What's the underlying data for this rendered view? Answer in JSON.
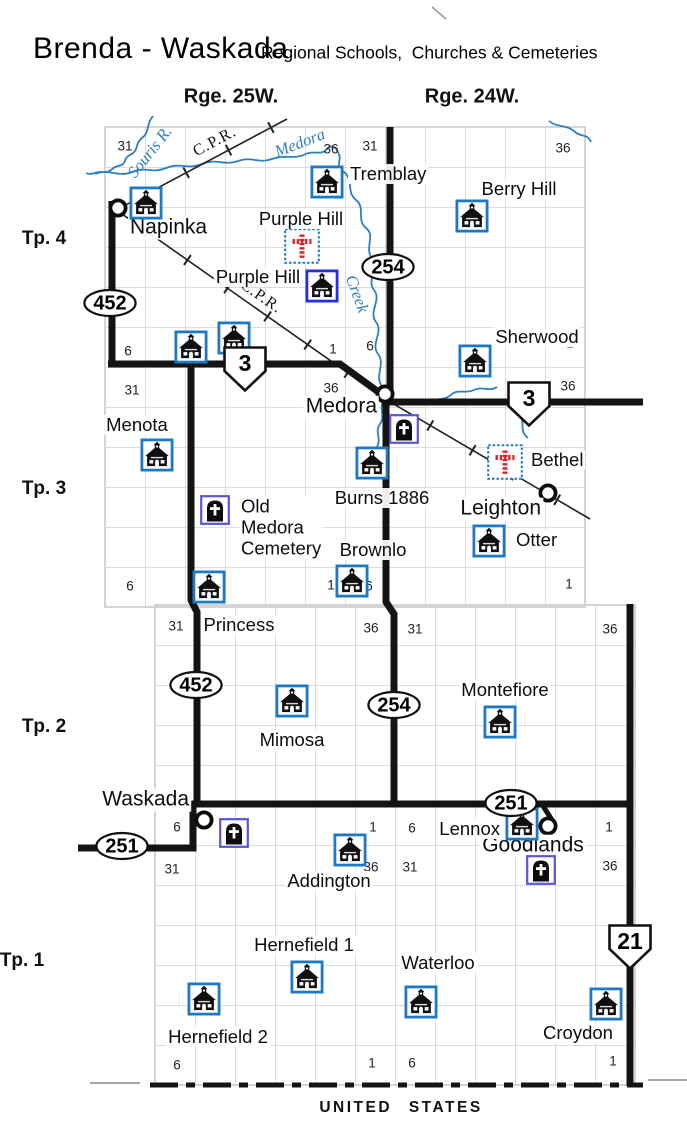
{
  "header": {
    "title": "Brenda - Waskada",
    "subtitle": "Regional Schools,  Churches & Cemeteries"
  },
  "colors": {
    "school": "#1d79c4",
    "school_alt": "#2330e0",
    "cem": "#5b54d6",
    "cross": "#d6252e",
    "water": "#2e7fc0",
    "road": "#141414",
    "grid": "#dcdcdc"
  },
  "map": {
    "border_label": "UNITED STATES",
    "range_labels": [
      {
        "label": "Rge. 25W.",
        "x": 231,
        "y": 97
      },
      {
        "label": "Rge. 24W.",
        "x": 472,
        "y": 97
      }
    ],
    "township_labels": [
      {
        "label": "Tp. 4",
        "x": 44,
        "y": 239
      },
      {
        "label": "Tp. 3",
        "x": 44,
        "y": 489
      },
      {
        "label": "Tp. 2",
        "x": 44,
        "y": 727
      },
      {
        "label": "Tp. 1",
        "x": 22,
        "y": 961
      }
    ],
    "railway_labels": [
      {
        "label": "C.P.R.",
        "x": 215,
        "y": 142,
        "rotate": -28
      },
      {
        "label": "C.P.R.",
        "x": 261,
        "y": 297,
        "rotate": 35
      }
    ],
    "water_labels": [
      {
        "label": "Souris R.",
        "x": 150,
        "y": 152,
        "rotate": -52
      },
      {
        "label": "Medora",
        "x": 300,
        "y": 143,
        "rotate": -21
      },
      {
        "label": "Creek",
        "x": 357,
        "y": 294,
        "rotate": 70
      }
    ],
    "section_numbers": [
      {
        "n": "31",
        "x": 125,
        "y": 146
      },
      {
        "n": "36",
        "x": 331,
        "y": 149
      },
      {
        "n": "31",
        "x": 370,
        "y": 146
      },
      {
        "n": "36",
        "x": 563,
        "y": 148
      },
      {
        "n": "6",
        "x": 128,
        "y": 351
      },
      {
        "n": "1",
        "x": 333,
        "y": 349
      },
      {
        "n": "6",
        "x": 370,
        "y": 346
      },
      {
        "n": "1",
        "x": 570,
        "y": 343
      },
      {
        "n": "31",
        "x": 132,
        "y": 390
      },
      {
        "n": "36",
        "x": 331,
        "y": 388
      },
      {
        "n": "36",
        "x": 568,
        "y": 386
      },
      {
        "n": "6",
        "x": 130,
        "y": 586
      },
      {
        "n": "1",
        "x": 331,
        "y": 585
      },
      {
        "n": "6",
        "x": 369,
        "y": 586
      },
      {
        "n": "1",
        "x": 569,
        "y": 584
      },
      {
        "n": "31",
        "x": 176,
        "y": 626
      },
      {
        "n": "36",
        "x": 371,
        "y": 628
      },
      {
        "n": "31",
        "x": 415,
        "y": 629
      },
      {
        "n": "36",
        "x": 610,
        "y": 629
      },
      {
        "n": "6",
        "x": 177,
        "y": 827
      },
      {
        "n": "1",
        "x": 373,
        "y": 827
      },
      {
        "n": "6",
        "x": 412,
        "y": 828
      },
      {
        "n": "1",
        "x": 609,
        "y": 827
      },
      {
        "n": "31",
        "x": 172,
        "y": 869
      },
      {
        "n": "36",
        "x": 371,
        "y": 867
      },
      {
        "n": "31",
        "x": 410,
        "y": 867
      },
      {
        "n": "36",
        "x": 610,
        "y": 866
      },
      {
        "n": "6",
        "x": 177,
        "y": 1065
      },
      {
        "n": "1",
        "x": 372,
        "y": 1063
      },
      {
        "n": "6",
        "x": 412,
        "y": 1063
      },
      {
        "n": "1",
        "x": 613,
        "y": 1061
      }
    ],
    "highways": [
      {
        "shape": "oval",
        "num": "452",
        "x": 110,
        "y": 303
      },
      {
        "shape": "oval",
        "num": "254",
        "x": 388,
        "y": 267
      },
      {
        "shape": "shield",
        "num": "3",
        "x": 245,
        "y": 369
      },
      {
        "shape": "shield",
        "num": "3",
        "x": 529,
        "y": 404
      },
      {
        "shape": "oval",
        "num": "452",
        "x": 196,
        "y": 685
      },
      {
        "shape": "oval",
        "num": "254",
        "x": 394,
        "y": 705
      },
      {
        "shape": "oval",
        "num": "251",
        "x": 122,
        "y": 846
      },
      {
        "shape": "oval",
        "num": "251",
        "x": 511,
        "y": 803
      },
      {
        "shape": "shield",
        "num": "21",
        "x": 630,
        "y": 947
      }
    ],
    "features": [
      {
        "kind": "town",
        "name": "napinka",
        "icon": {
          "x": 118,
          "y": 208
        },
        "label": "Napinka",
        "label_pos": {
          "x": 128,
          "y": 228,
          "anchor": "start"
        }
      },
      {
        "kind": "town",
        "name": "medora",
        "icon": {
          "x": 385,
          "y": 394
        },
        "label": "Medora",
        "label_pos": {
          "x": 379,
          "y": 407,
          "anchor": "end"
        }
      },
      {
        "kind": "town",
        "name": "leighton",
        "icon": {
          "x": 548,
          "y": 493
        },
        "label": "Leighton",
        "label_pos": {
          "x": 543,
          "y": 509,
          "anchor": "end"
        }
      },
      {
        "kind": "town",
        "name": "waskada",
        "icon": {
          "x": 204,
          "y": 820
        },
        "label": "Waskada",
        "label_pos": {
          "x": 191,
          "y": 800,
          "anchor": "end"
        }
      },
      {
        "kind": "town",
        "name": "goodlands",
        "icon": {
          "x": 548,
          "y": 826
        },
        "label": "Goodlands",
        "label_pos": {
          "x": 533,
          "y": 846,
          "anchor": "middle"
        }
      },
      {
        "kind": "school",
        "name": "napinka-school",
        "icon": {
          "x": 146,
          "y": 203
        }
      },
      {
        "kind": "school",
        "name": "tremblay",
        "icon": {
          "x": 327,
          "y": 182
        },
        "label": "Tremblay",
        "label_pos": {
          "x": 348,
          "y": 174,
          "anchor": "start"
        }
      },
      {
        "kind": "school",
        "name": "berry-hill",
        "icon": {
          "x": 472,
          "y": 216
        },
        "label": "Berry Hill",
        "label_pos": {
          "x": 519,
          "y": 189,
          "anchor": "middle"
        }
      },
      {
        "kind": "red_cross",
        "name": "purple-hill-church",
        "icon": {
          "x": 302,
          "y": 246
        },
        "label": "Purple Hill",
        "label_pos": {
          "x": 301,
          "y": 219,
          "anchor": "middle"
        }
      },
      {
        "kind": "school",
        "name": "purple-hill-school",
        "variant": "royal",
        "icon": {
          "x": 322,
          "y": 286
        },
        "label": "Purple Hill",
        "label_pos": {
          "x": 258,
          "y": 277,
          "anchor": "middle"
        }
      },
      {
        "kind": "school",
        "name": "hwy3-school-west",
        "icon": {
          "x": 191,
          "y": 347
        }
      },
      {
        "kind": "school",
        "name": "hwy3-school-east",
        "icon": {
          "x": 234,
          "y": 338
        }
      },
      {
        "kind": "school",
        "name": "sherwood",
        "icon": {
          "x": 475,
          "y": 361
        },
        "label": "Sherwood",
        "label_pos": {
          "x": 537,
          "y": 337,
          "anchor": "middle"
        }
      },
      {
        "kind": "school",
        "name": "menota",
        "icon": {
          "x": 157,
          "y": 455
        },
        "label": "Menota",
        "label_pos": {
          "x": 137,
          "y": 425,
          "anchor": "middle"
        }
      },
      {
        "kind": "cemetery",
        "name": "medora-cemetery",
        "icon": {
          "x": 404,
          "y": 429
        }
      },
      {
        "kind": "school",
        "name": "burns",
        "icon": {
          "x": 372,
          "y": 463
        },
        "label": "Burns 1886",
        "label_pos": {
          "x": 382,
          "y": 498,
          "anchor": "middle"
        }
      },
      {
        "kind": "red_cross",
        "name": "bethel",
        "icon": {
          "x": 505,
          "y": 462
        },
        "label": "Bethel",
        "label_pos": {
          "x": 529,
          "y": 460,
          "anchor": "start"
        }
      },
      {
        "kind": "school",
        "name": "otter",
        "icon": {
          "x": 489,
          "y": 541
        },
        "label": "Otter",
        "label_pos": {
          "x": 514,
          "y": 540,
          "anchor": "start"
        }
      },
      {
        "kind": "cemetery",
        "name": "old-medora-cemetery",
        "icon": {
          "x": 215,
          "y": 510
        },
        "label_lines": [
          "Old",
          "Medora",
          "Cemetery"
        ],
        "label_pos": {
          "x": 239,
          "y": 527,
          "anchor": "start"
        }
      },
      {
        "kind": "school",
        "name": "princess",
        "icon": {
          "x": 209,
          "y": 587
        },
        "label": "Princess",
        "label_pos": {
          "x": 239,
          "y": 625,
          "anchor": "middle"
        }
      },
      {
        "kind": "school",
        "name": "brownlo",
        "icon": {
          "x": 352,
          "y": 581
        },
        "label": "Brownlo",
        "label_pos": {
          "x": 373,
          "y": 550,
          "anchor": "middle"
        }
      },
      {
        "kind": "school",
        "name": "mimosa",
        "icon": {
          "x": 292,
          "y": 701
        },
        "label": "Mimosa",
        "label_pos": {
          "x": 292,
          "y": 740,
          "anchor": "middle"
        }
      },
      {
        "kind": "school",
        "name": "montefiore",
        "icon": {
          "x": 500,
          "y": 722
        },
        "label": "Montefiore",
        "label_pos": {
          "x": 505,
          "y": 690,
          "anchor": "middle"
        }
      },
      {
        "kind": "cemetery",
        "name": "waskada-cemetery",
        "icon": {
          "x": 234,
          "y": 833
        }
      },
      {
        "kind": "school",
        "name": "lennox",
        "icon": {
          "x": 522,
          "y": 824
        },
        "label": "Lennox",
        "label_pos": {
          "x": 502,
          "y": 829,
          "anchor": "end"
        }
      },
      {
        "kind": "cemetery",
        "name": "goodlands-cemetery",
        "icon": {
          "x": 541,
          "y": 870
        }
      },
      {
        "kind": "school",
        "name": "addington",
        "icon": {
          "x": 350,
          "y": 850
        },
        "label": "Addington",
        "label_pos": {
          "x": 329,
          "y": 881,
          "anchor": "middle"
        }
      },
      {
        "kind": "school",
        "name": "hernefield-1",
        "icon": {
          "x": 307,
          "y": 977
        },
        "label": "Hernefield 1",
        "label_pos": {
          "x": 304,
          "y": 945,
          "anchor": "middle"
        }
      },
      {
        "kind": "school",
        "name": "hernefield-2",
        "icon": {
          "x": 204,
          "y": 999
        },
        "label": "Hernefield 2",
        "label_pos": {
          "x": 218,
          "y": 1037,
          "anchor": "middle"
        }
      },
      {
        "kind": "school",
        "name": "waterloo",
        "icon": {
          "x": 421,
          "y": 1002
        },
        "label": "Waterloo",
        "label_pos": {
          "x": 438,
          "y": 963,
          "anchor": "middle"
        }
      },
      {
        "kind": "school",
        "name": "croydon",
        "icon": {
          "x": 606,
          "y": 1004
        },
        "label": "Croydon",
        "label_pos": {
          "x": 578,
          "y": 1033,
          "anchor": "middle"
        }
      }
    ]
  }
}
